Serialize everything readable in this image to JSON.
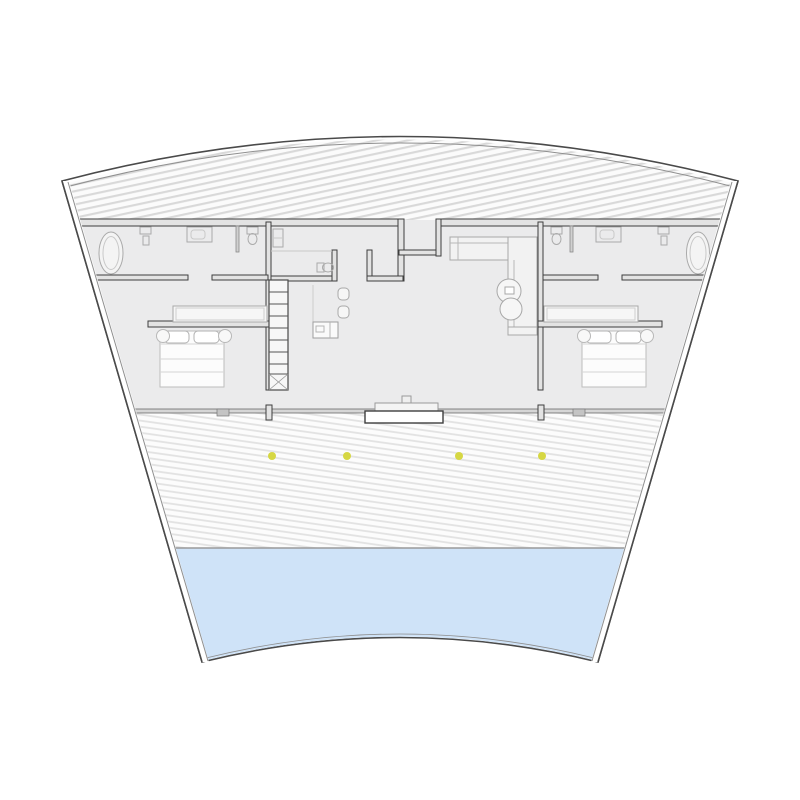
{
  "title": "fan-shaped-house-floor-plan",
  "scene": {
    "type": "architectural floor plan of a curved (fan-shaped) building",
    "zones": [
      "hatched roof band",
      "bathrooms",
      "bedrooms",
      "stair hall",
      "central wc",
      "living room",
      "hatched terrace with lights",
      "pool"
    ]
  },
  "colors": {
    "background": "#ffffff",
    "outline": "#4a4a4a",
    "outline_inner": "#8f8f8f",
    "wall_fill": "#e3e3e3",
    "wall_stroke": "#3e3e3e",
    "floor_fill": "#ebebec",
    "hatch_roof_line": "#d9d9d9",
    "hatch_roof_bg": "#fbfbfb",
    "hatch_terrace_line": "#e2e2e2",
    "hatch_terrace_bg": "#fcfcfc",
    "pool_fill": "#cfe3f8",
    "pool_edge": "#9a9a9a",
    "glass_wall_fill": "#d6d6d6",
    "glass_wall_stroke": "#6a6a6a",
    "stairs_stroke": "#4a4a4a",
    "tread_stroke": "#555555",
    "furniture_stroke": "#aaaaaa",
    "furniture_soft_stroke": "#c9c9c9",
    "furniture_fill": "#f4f4f4",
    "bed_fill": "#fcfcfc",
    "light_dot": "#d6d743",
    "door_fill": "#c4c4c4"
  },
  "terrace_lights": {
    "count": 4,
    "radius": 4,
    "y": 456,
    "x": [
      272,
      347,
      459,
      542
    ]
  },
  "rooms": [
    {
      "id": "roof-band"
    },
    {
      "id": "bathroom-left"
    },
    {
      "id": "bathroom-right"
    },
    {
      "id": "bedroom-left"
    },
    {
      "id": "bedroom-right"
    },
    {
      "id": "stair-hall"
    },
    {
      "id": "wc-center"
    },
    {
      "id": "living-room"
    },
    {
      "id": "terrace"
    },
    {
      "id": "pool"
    }
  ],
  "furniture": [
    "bathtub-left",
    "pedestal-sink-left",
    "vanity-left",
    "toilet-left",
    "shelf-left",
    "stairs",
    "wc-toilet",
    "desk",
    "desk-chairs",
    "sofa-l-shaped",
    "round-table",
    "wardrobe-left",
    "bed-left",
    "nightstands-left",
    "toilet-right",
    "vanity-right",
    "pedestal-sink-right",
    "bathtub-right",
    "wardrobe-right",
    "bed-right",
    "nightstands-right",
    "entry-step",
    "glass-facade",
    "terrace-lights",
    "pool"
  ]
}
